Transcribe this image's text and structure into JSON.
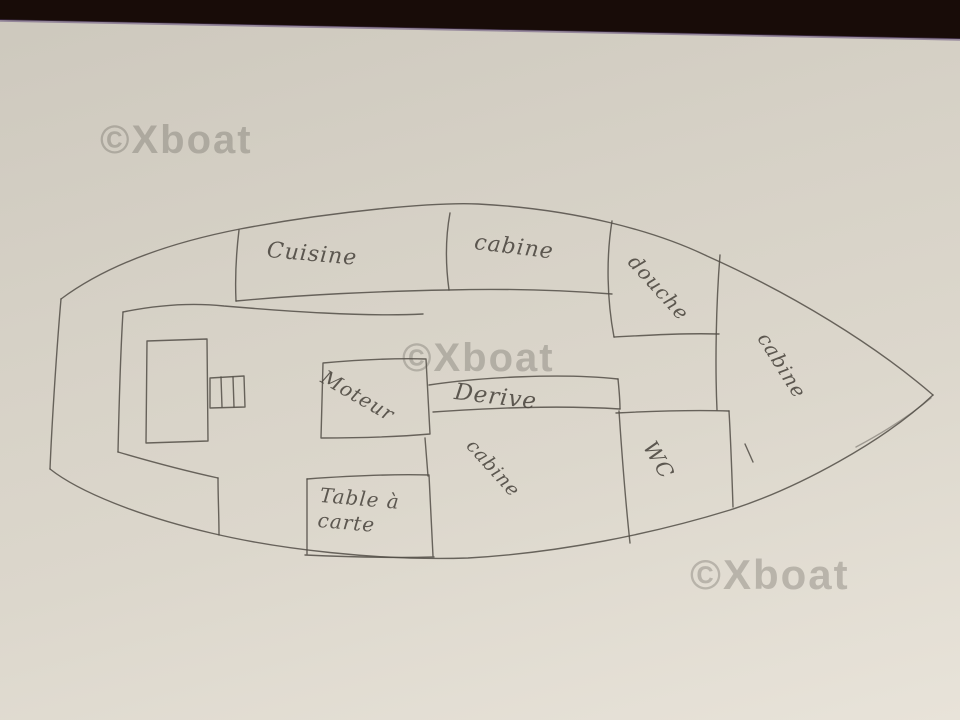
{
  "watermark": {
    "text": "©Xboat"
  },
  "labels": {
    "cuisine": "Cuisine",
    "cabin_fore": "cabine",
    "shower": "douche",
    "cabin_bow": "cabine",
    "engine": "Moteur",
    "centerboard": "Derive",
    "cabin_mid": "cabine",
    "wc": "WC",
    "chart_table_line1": "Table à",
    "chart_table_line2": "carte"
  },
  "colors": {
    "paper_dark": "#cdc8bd",
    "paper_light": "#e8e3d9",
    "ink": "#524d46",
    "photo_edge_dark": "#180c08",
    "photo_edge_tint": "#5a4475",
    "watermark_gray": "#5a5650"
  }
}
